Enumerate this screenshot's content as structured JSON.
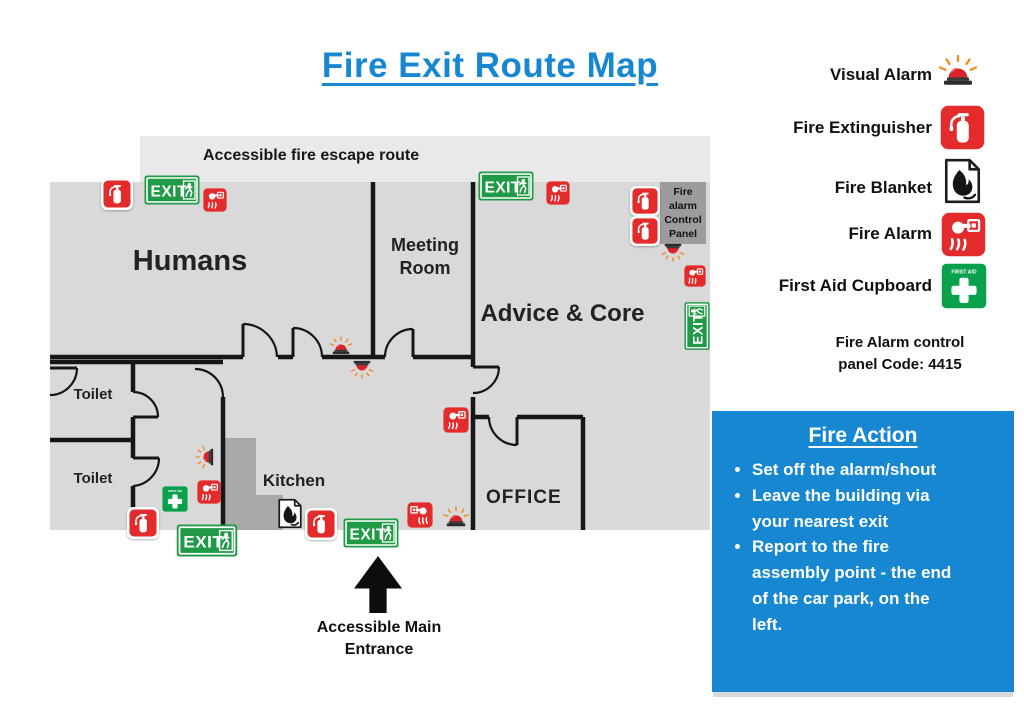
{
  "title": "Fire Exit Route Map",
  "legend": {
    "items": [
      {
        "label": "Visual Alarm",
        "icon": "visual-alarm-icon"
      },
      {
        "label": "Fire Extinguisher",
        "icon": "fire-extinguisher-icon"
      },
      {
        "label": "Fire Blanket",
        "icon": "fire-blanket-icon"
      },
      {
        "label": "Fire Alarm",
        "icon": "fire-alarm-icon"
      },
      {
        "label": "First Aid Cupboard",
        "icon": "first-aid-cupboard-icon"
      }
    ],
    "code_note": "Fire Alarm control panel Code: 4415"
  },
  "fire_action": {
    "title": "Fire Action",
    "bullets": [
      "Set off the alarm/shout",
      "Leave the building via your nearest exit",
      "Report to the fire assembly point - the end of the car park, on the left."
    ]
  },
  "map": {
    "escape_route_label": "Accessible fire escape route",
    "rooms": {
      "humans": "Humans",
      "meeting_room": "Meeting Room",
      "advice_core": "Advice & Core",
      "toilet_upper": "Toilet",
      "toilet_lower": "Toilet",
      "kitchen": "Kitchen",
      "office": "OFFICE"
    },
    "control_panel_label": "Fire alarm Control Panel",
    "entrance_label": "Accessible Main Entrance",
    "exit_sign_text": "EXIT",
    "first_aid_text": "FIRST AID"
  },
  "icons": {
    "visual-alarm-icon": "red siren beacon with orange rays",
    "fire-extinguisher-icon": "white extinguisher on red square",
    "fire-blanket-icon": "black flame on white sheet",
    "fire-alarm-icon": "hand pressing call point on red square",
    "first-aid-cupboard-icon": "white cross on green square",
    "exit-sign-icon": "green EXIT sign with running man",
    "entrance-arrow-icon": "black up arrow"
  },
  "colors": {
    "accent_blue": "#1787d1",
    "exit_green": "#219a47",
    "alarm_red": "#e32b2b",
    "ray_orange": "#f28a1e",
    "floor_gray": "#d9d9d9",
    "route_gray": "#e9e9e9",
    "stairs_gray": "#a9a9a9"
  }
}
